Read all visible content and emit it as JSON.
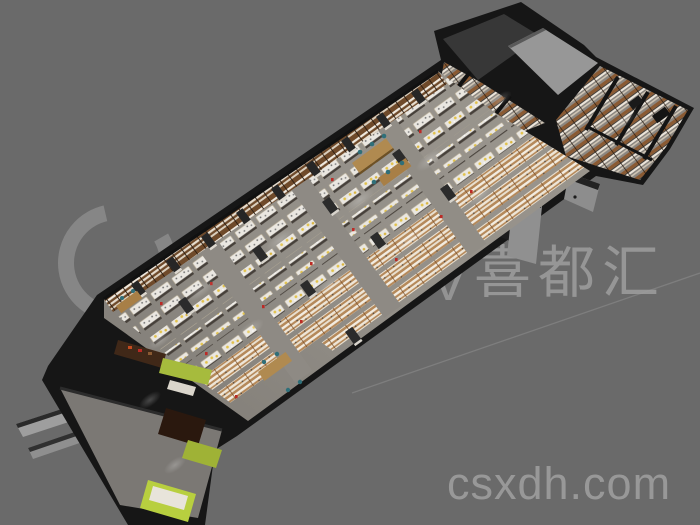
{
  "scene": {
    "description": "3D isometric cutaway render of a retail store interior floor plan, viewed from above at an angle on a plain gray backdrop",
    "building": {
      "main_hall_label": "main retail hall with rows of white display counters",
      "annex_label": "back rooms with wall shelving",
      "entrance_label": "entrance corridor with green display cases",
      "dock_label": "loading ramp slabs"
    }
  },
  "palette": {
    "background": "#6a6a6a",
    "watermark": "#9e9e9e",
    "walls": "#161616",
    "floor": "#8e8a84",
    "corridor_floor": "#7b7874",
    "shelf_brown": "#6f4a2a",
    "wing_shelf_tan": "#8a5a33",
    "counter_white": "#eae7e1",
    "counter_tan": "#b5895a",
    "wood": "#b08a50",
    "teal_chair": "#2f6f79",
    "lime_green": "#a6bb3d",
    "yellow_product": "#e2c24a",
    "red_accent": "#bb2a26",
    "ramp_gray": "#9e9e9e",
    "porch_gray": "#909090",
    "dark_room": "#373737",
    "slab_wall_gray": "#979797"
  },
  "watermarks": {
    "logo_icon": "c-swirl-logo",
    "logo_letter": "V",
    "brand": "喜都汇",
    "website": "csxdh.com"
  }
}
